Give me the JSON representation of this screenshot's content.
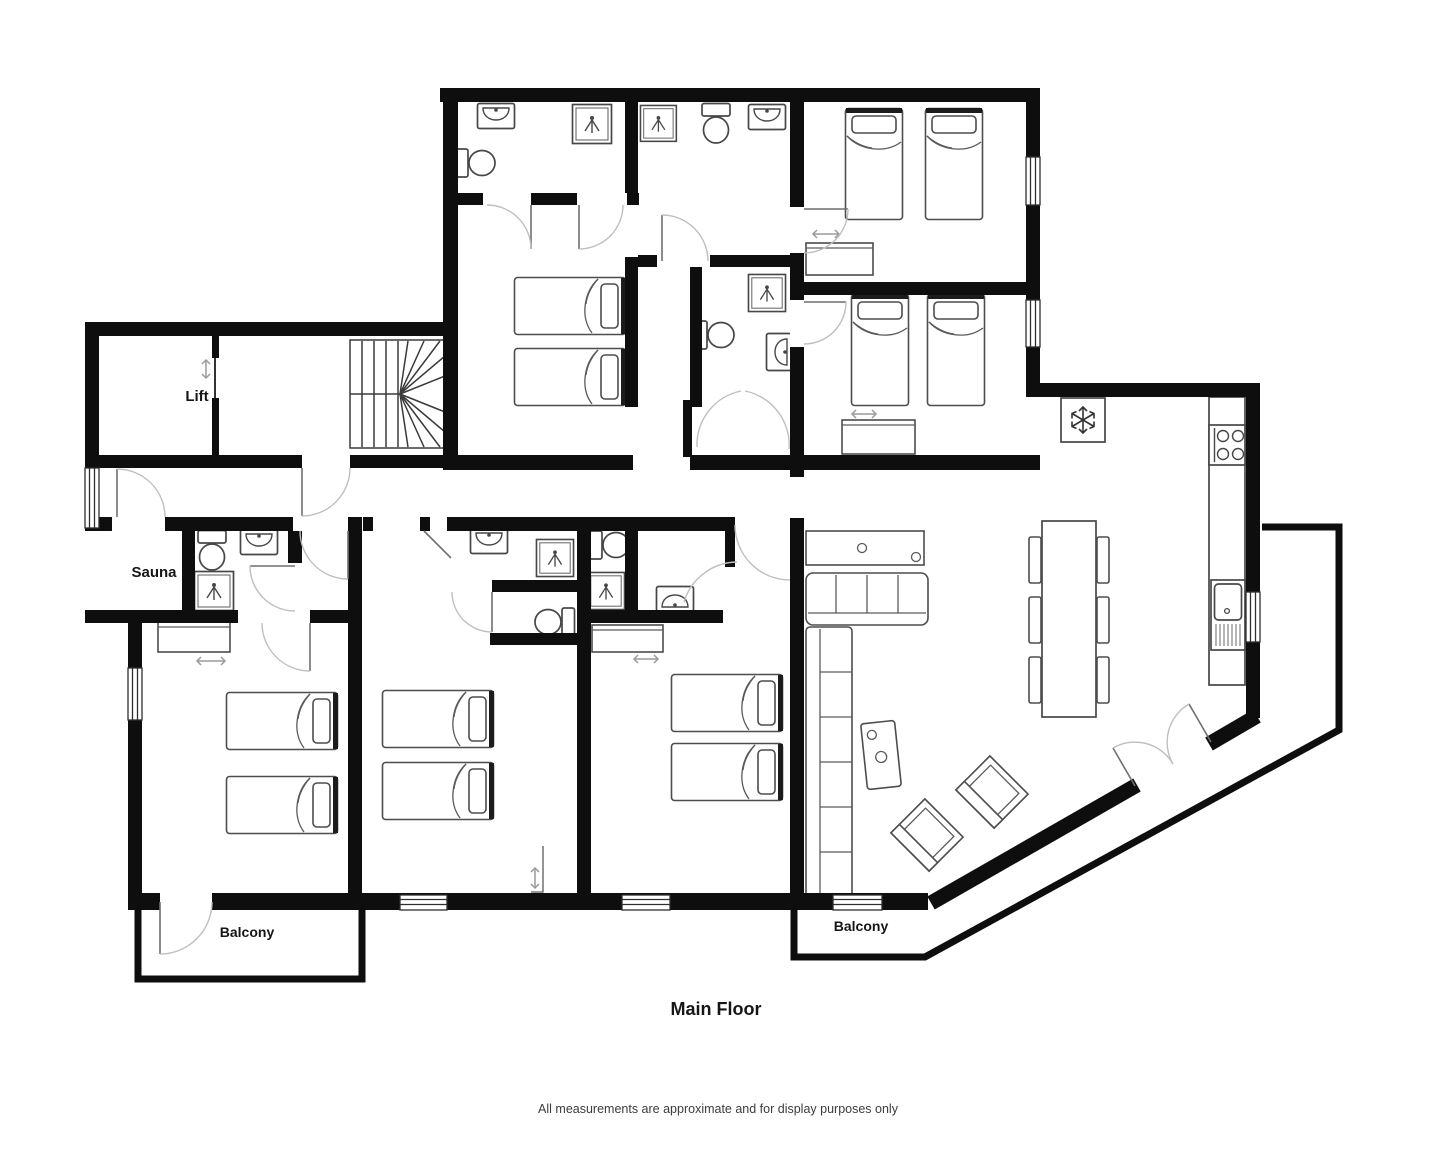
{
  "plan": {
    "title": "Main Floor",
    "disclaimer": "All measurements are approximate and for display purposes only",
    "room_labels": {
      "lift": "Lift",
      "sauna": "Sauna",
      "balcony_left": "Balcony",
      "balcony_right": "Balcony"
    },
    "colors": {
      "wall": "#0e0e0e",
      "background": "#ffffff",
      "furniture_outline": "#4d4d4d",
      "door_arc": "#bfbfbf",
      "label_text": "#161616"
    },
    "rooms": [
      {
        "name": "Lift"
      },
      {
        "name": "Stairwell",
        "fixtures": [
          "winder staircase"
        ]
      },
      {
        "name": "Sauna"
      },
      {
        "name": "Bathroom top-left",
        "fixtures": [
          "sink",
          "toilet",
          "shower"
        ]
      },
      {
        "name": "Bathroom top-middle",
        "fixtures": [
          "shower",
          "toilet",
          "sink"
        ]
      },
      {
        "name": "Inner shower room",
        "fixtures": [
          "shower",
          "toilet",
          "sink"
        ]
      },
      {
        "name": "Bedroom top-centre",
        "beds": 2
      },
      {
        "name": "Twin bedroom top-right upper",
        "beds": 2,
        "wardrobe": true
      },
      {
        "name": "Twin bedroom top-right lower",
        "beds": 2,
        "wardrobe": true
      },
      {
        "name": "Bedroom bottom-left",
        "beds": 2,
        "wardrobe": true
      },
      {
        "name": "Bedroom bottom-middle",
        "beds": 2,
        "ensuite": [
          "sink",
          "shower",
          "toilet"
        ]
      },
      {
        "name": "Bedroom bottom-centre",
        "beds": 2,
        "ensuite": [
          "toilet",
          "shower",
          "sink"
        ],
        "wardrobe": true
      },
      {
        "name": "Ensuite sauna wing",
        "fixtures": [
          "toilet",
          "sink",
          "shower"
        ]
      },
      {
        "name": "Open-plan kitchen living dining",
        "fixtures": [
          "fridge",
          "stove",
          "counter",
          "kitchen sink",
          "dining table",
          "6 dining chairs",
          "sideboard",
          "sofa",
          "corner sofa",
          "stove unit",
          "2 lounge chairs"
        ]
      },
      {
        "name": "Balcony left"
      },
      {
        "name": "Balcony right"
      }
    ]
  }
}
